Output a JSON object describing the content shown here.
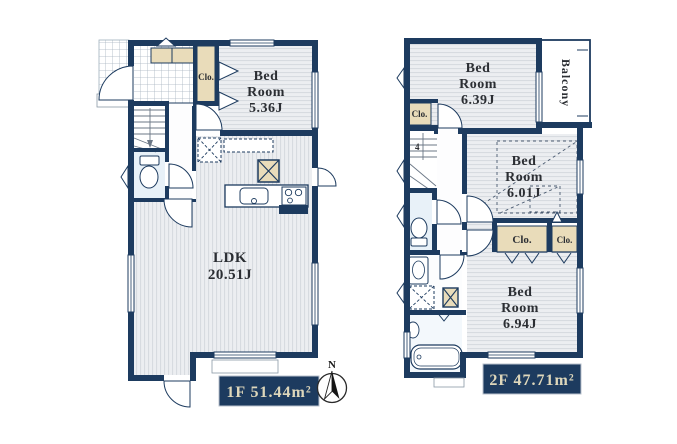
{
  "palette": {
    "wall": "#1d3b5f",
    "closet_fill": "#e9dcba",
    "floor_stripe_base": "#eceef1",
    "floor_stripe_line": "#d7dbe0",
    "wet_room_fill": "#e8f1f8",
    "tile_line": "#a7b4c0",
    "area_box_bg": "#1d3b5f",
    "area_box_text": "#ded7bb"
  },
  "floor1": {
    "bedroom": {
      "lines": [
        "Bed",
        "Room",
        "5.36J"
      ]
    },
    "ldk": {
      "lines": [
        "LDK",
        "20.51J"
      ]
    },
    "closet_label": "Clo.",
    "area_label": "1F 51.44m²"
  },
  "floor2": {
    "bedroom_top": {
      "lines": [
        "Bed",
        "Room",
        "6.39J"
      ]
    },
    "bedroom_mid": {
      "lines": [
        "Bed",
        "Room",
        "6.01J"
      ]
    },
    "bedroom_bottom": {
      "lines": [
        "Bed",
        "Room",
        "6.94J"
      ]
    },
    "balcony_label": "Balcony",
    "closet_hall_label": "Clo.",
    "closet_mid_label": "Clo.",
    "closet_right_label": "Clo.",
    "stair_count_label": "4",
    "area_label": "2F 47.71m²"
  },
  "compass": {
    "north_label": "N"
  }
}
